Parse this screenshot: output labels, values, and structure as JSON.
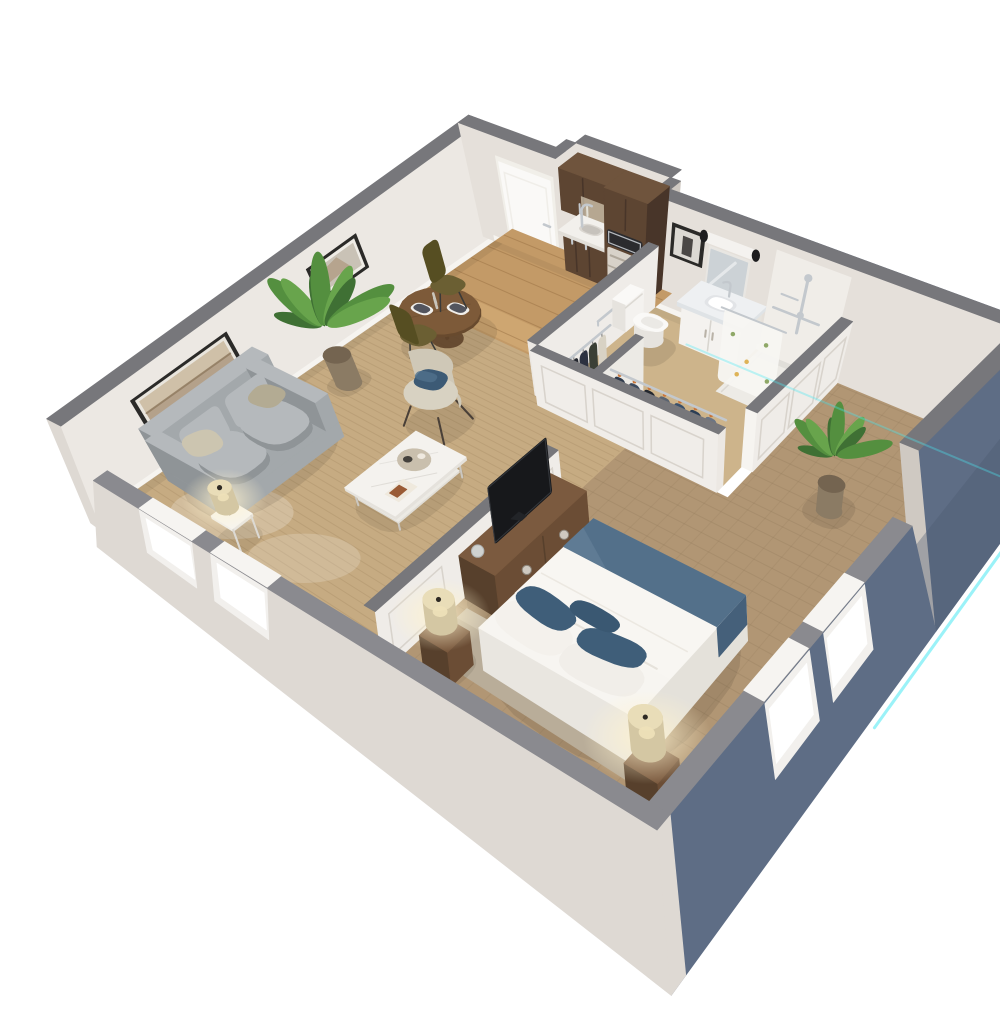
{
  "meta": {
    "title": "One-bedroom apartment - 3D isometric cutaway floor plan",
    "style": "photorealistic dollhouse render on white background"
  },
  "render": {
    "background": "#ffffff",
    "edge_glow": "#4ae9f3",
    "projection": "isometric-perspective cutaway",
    "cut_wall_height": "one-third"
  },
  "palette": {
    "bg": "#ffffff",
    "roof": "#77777b",
    "roofLight": "#8a8a8f",
    "wallIn": "#ece8e3",
    "wallNE": "#e5e0da",
    "panelLine": "#d8d3cc",
    "baseboard": "#f6f4f0",
    "extCream": "#ded9d3",
    "extCreamDark": "#cfc9c2",
    "extBlue": "#5e6d85",
    "extBlueDark": "#4c5a70",
    "carpet": "#c6ab82",
    "carpetLine": "#aa8f67",
    "wood": "#c39a67",
    "woodLine": "#9a7244",
    "woodLight": "#d2ab75",
    "bathFloor": "#cdb48b",
    "bedCarpet": "#b19674",
    "bedCarpetLine": "#8f7758",
    "showerPan": "#edebe6",
    "cabinet": "#5d4532",
    "cabinetDark": "#483529",
    "cabinetTop": "#6f543d",
    "counter": "#f2f0ec",
    "counterEdge": "#e1ded8",
    "fridge": "#d8d2c9",
    "fridgeLine": "#b0a89c",
    "micro": "#2b2b2e",
    "silver": "#c3c8cd",
    "doorWhite": "#faf9f7",
    "doorShade": "#f0eee9",
    "frameDark": "#2b2a28",
    "artSand": "#b4a18a",
    "artSky": "#cfc0a8",
    "artBand": "#8f7a5f",
    "artGray": "#c9c2b6",
    "artBlue": "#8fa3ad",
    "mirror": "#ccd2d6",
    "white": "#f4f2ef",
    "toiletShade": "#e6e3de",
    "marble": "#eef0f2",
    "marbleEdge": "#dfe3e6",
    "sofa": "#a3a8ab",
    "sofaDark": "#8f9497",
    "sofaLight": "#b5b9bc",
    "pillowBeige": "#ccc5b0",
    "pillowTan": "#b3ab93",
    "chairBeige": "#cfc8b7",
    "chairBeigeDark": "#bcb5a4",
    "chairTop": "#d8d2c2",
    "navy": "#3c5a75",
    "tableWood": "#7d5a39",
    "tableWoodDark": "#684a2e",
    "olive": "#6b5f33",
    "oliveDark": "#564e22",
    "coffeeWhite": "#f4f2ee",
    "coffeeEdge": "#e5e2dc",
    "lampCream": "#d4c7a3",
    "lampTop": "#e9ddb8",
    "duvet": "#f7f5f1",
    "duvetShade": "#e9e6e0",
    "throwBlue": "#53708a",
    "throwBlueDark": "#45607a",
    "pillowNavy": "#3f5e79",
    "headboard": "#c6bba8",
    "nightWood": "#6b4d35",
    "nightWoodDark": "#57402c",
    "nightWoodTop": "#7b5a3f",
    "tv": "#17181b",
    "tvEdge": "#34373c",
    "leafDark": "#3f7034",
    "leaf": "#548f3f",
    "leafLight": "#68a44c",
    "stem": "#3c6b2f",
    "pot": "#8b7b64",
    "potDark": "#746450",
    "curtain": "#f7f6f3",
    "curtainDot1": "#d9a73c",
    "curtainDot2": "#7d9a4f",
    "winFrame": "#f2f0ed",
    "glass": "#ffffff",
    "shadow": "#3a3226",
    "glow": "#4ae9f3"
  },
  "wardrobe_colors": [
    "#2e3a4c",
    "#3d4a5e",
    "#23272e",
    "#5a6370",
    "#39506b",
    "#2c3e55",
    "#6b7585"
  ],
  "coat_colors": [
    "#23262e",
    "#2c3140",
    "#3a3f35",
    "#d8d2c4"
  ],
  "hanger_accent": "#c9763a",
  "rooms": [
    {
      "name": "living-room",
      "furniture": [
        "loveseat-sofa",
        "accent-chair",
        "coffee-table",
        "side-table",
        "table-lamp",
        "potted-plant",
        "round-dining-table",
        "dining-chair",
        "dining-chair",
        "wall-art-landscape",
        "wall-art-abstract",
        "window",
        "window"
      ]
    },
    {
      "name": "kitchen",
      "furniture": [
        "upper-cabinets",
        "base-cabinets",
        "counter-sink",
        "faucet",
        "microwave",
        "refrigerator"
      ]
    },
    {
      "name": "entry",
      "furniture": [
        "entry-door"
      ]
    },
    {
      "name": "bathroom",
      "furniture": [
        "toilet",
        "vanity-with-sink",
        "mirror",
        "vanity-light",
        "framed-photo",
        "grab-bars",
        "walk-in-shower",
        "hand-shower",
        "shower-curtain"
      ]
    },
    {
      "name": "closets",
      "furniture": [
        "coat-rod",
        "hanging-coats",
        "wardrobe-rod",
        "hanging-clothes"
      ]
    },
    {
      "name": "bedroom",
      "furniture": [
        "queen-bed",
        "headboard",
        "nightstand",
        "nightstand",
        "drum-table-lamp",
        "drum-table-lamp",
        "media-dresser",
        "flat-screen-tv",
        "potted-plant",
        "window",
        "window"
      ]
    }
  ]
}
